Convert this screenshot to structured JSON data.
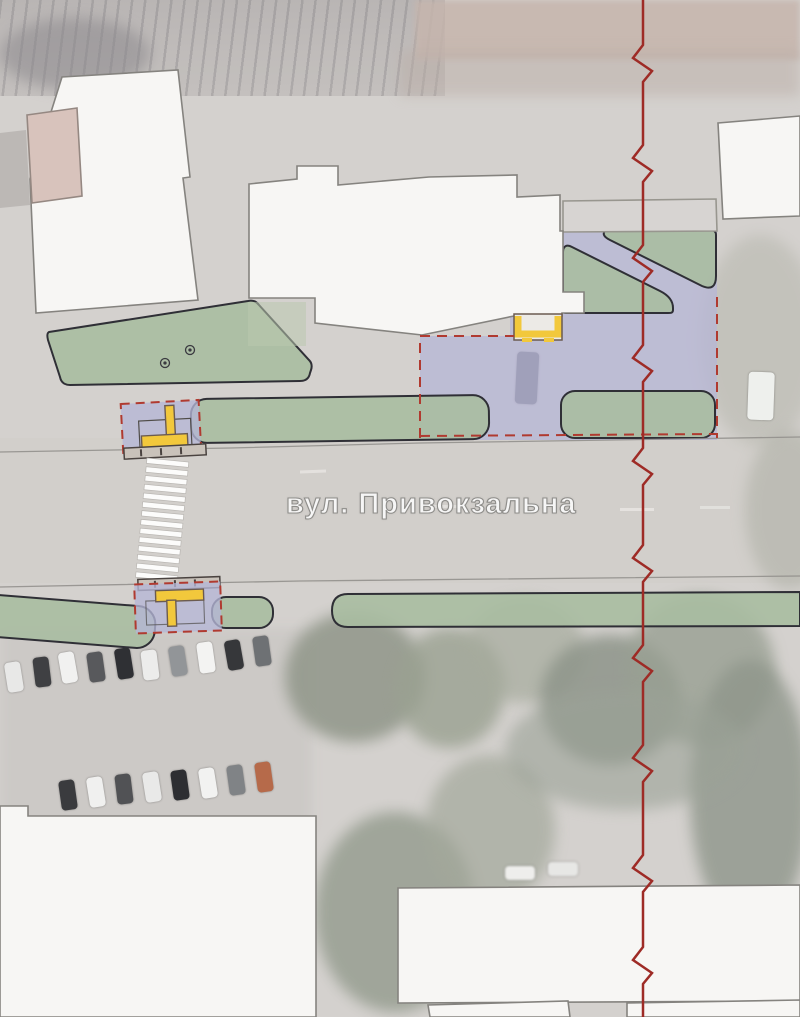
{
  "labels": {
    "street": "вул. Привокзальна"
  },
  "colors": {
    "section_line_red": "#9e2b26",
    "boundary_dashed_red": "#b03a30",
    "greenery_fill": "#a9bca1",
    "greenery_outline": "#2f2f36",
    "paving_overlay_purple": "#b5b6d6",
    "entrance_marker_yellow": "#f2c83c",
    "building_fill": "#f7f6f4",
    "building_outline": "#85837f",
    "existing_building_fill": "#d7d4d2",
    "crosswalk_stripe": "#fcfcfb",
    "tactile_strip": "#c9c2ba"
  }
}
